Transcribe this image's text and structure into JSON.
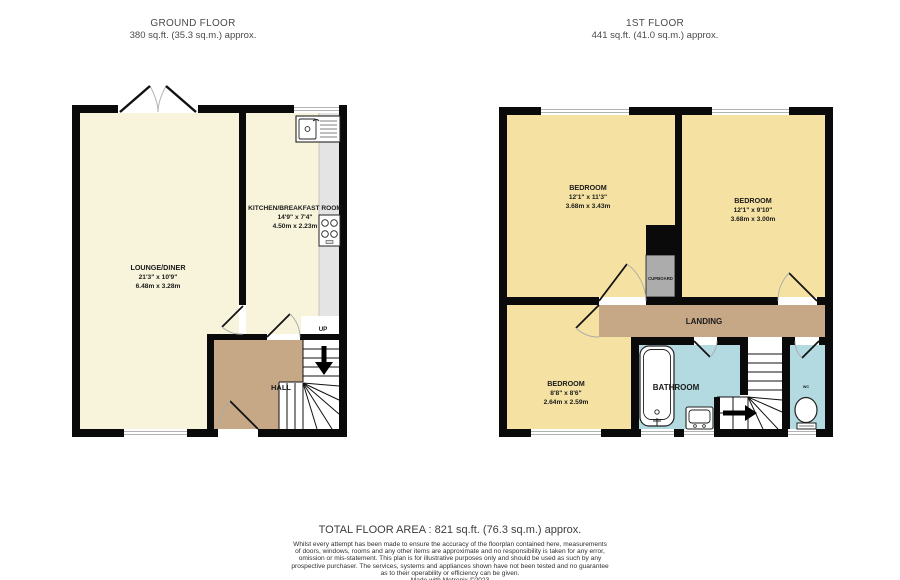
{
  "ground_floor": {
    "title": "GROUND FLOOR",
    "subtitle": "380 sq.ft. (35.3 sq.m.) approx.",
    "rooms": {
      "lounge_diner": {
        "name": "LOUNGE/DINER",
        "dims_imperial": "21'3\" x 10'9\"",
        "dims_metric": "6.48m x 3.28m"
      },
      "kitchen": {
        "name": "KITCHEN/BREAKFAST ROOM",
        "dims_imperial": "14'9\" x 7'4\"",
        "dims_metric": "4.50m x 2.23m"
      },
      "hall": {
        "name": "HALL"
      }
    },
    "stairs": {
      "direction_label": "UP"
    }
  },
  "first_floor": {
    "title": "1ST FLOOR",
    "subtitle": "441 sq.ft. (41.0 sq.m.) approx.",
    "rooms": {
      "bedroom_1": {
        "name": "BEDROOM",
        "dims_imperial": "12'1\" x 11'3\"",
        "dims_metric": "3.68m x 3.43m"
      },
      "bedroom_2": {
        "name": "BEDROOM",
        "dims_imperial": "12'1\" x 9'10\"",
        "dims_metric": "3.68m x 3.00m"
      },
      "bedroom_3": {
        "name": "BEDROOM",
        "dims_imperial": "8'8\" x 8'6\"",
        "dims_metric": "2.64m x 2.59m"
      },
      "bathroom": {
        "name": "BATHROOM"
      },
      "landing": {
        "name": "LANDING"
      },
      "cupboard": {
        "name": "CUPBOARD"
      },
      "wc": {
        "name": "WC"
      }
    }
  },
  "footer": {
    "total_area": "TOTAL FLOOR AREA : 821 sq.ft. (76.3 sq.m.) approx.",
    "disclaimer_lines": [
      "Whilst every attempt has been made to ensure the accuracy of the floorplan contained here, measurements",
      "of doors, windows, rooms and any other items are approximate and no responsibility is taken for any error,",
      "omission or mis-statement. This plan is for illustrative purposes only and should be used as such by any",
      "prospective purchaser. The services, systems and appliances shown have not been tested and no guarantee",
      "as to their operability or efficiency can be given."
    ],
    "credit": "Made with Metropix ©2023"
  },
  "colors": {
    "room_cream": "#F8F4DB",
    "room_yellow": "#F5E2A3",
    "hall_brown": "#C6A887",
    "wet_room_blue": "#B3DAE1",
    "counter_gray": "#E4E4E4",
    "cupboard_gray": "#ACACAC",
    "wall_black": "#0A0A0A"
  }
}
